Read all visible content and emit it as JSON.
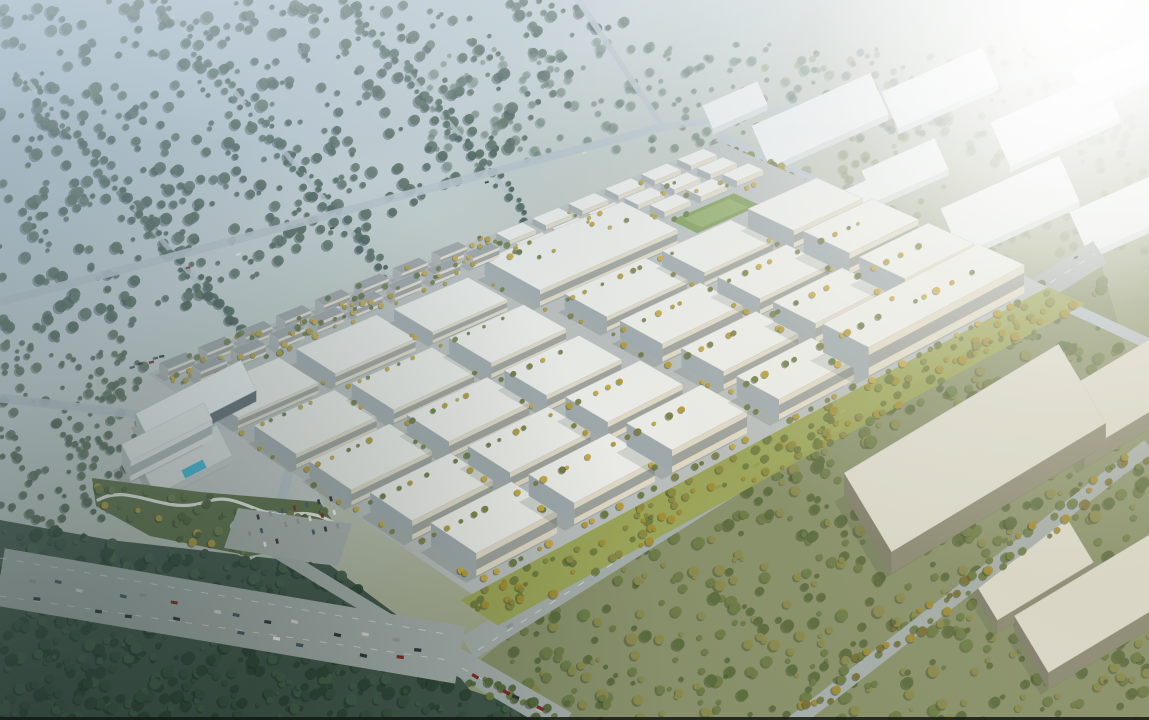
{
  "scene": "aerial-masterplan-render-industrial-park",
  "seed": 7,
  "palette": {
    "sky_tl": "#9db3c3",
    "sky_mid": "#c6d1d3",
    "ground_mid": "#b6bcab",
    "ground_olive": "#8f976f",
    "ground_deep": "#6e7a55",
    "haze_white": "#ffffff",
    "dark_corner": "#102019",
    "warm_tint": "#d6c89a",
    "tl_haze": "#a9becc",
    "road": "#a4adaa",
    "road_pale": "#b6c2c9",
    "dash": "#e9edeb",
    "campus_ground": "#b7bdbb",
    "roof": "#e9eae5",
    "roof_stroke": "#c2c7c1",
    "wall_front": "#ddd7c3",
    "wall_left": "#9ea8ab",
    "wall_right": "#ccccc0",
    "win_band": "#5d6b74",
    "res_roof": "#9aa1a3",
    "res_front": "#e2dccc",
    "res_left": "#a7adad",
    "res_right": "#d4d1c4",
    "res_win": "#55606a",
    "distant_roof": "#e7ebea",
    "distant_face": "#d2d9d8",
    "box_roof": "#dad8cb",
    "box_front": "#8b8974",
    "box_left": "#7f7d6a",
    "box_right": "#bcb9a7",
    "shadow": "#2e3e38",
    "greenway": "#99a352",
    "field_green": "#7d9a55",
    "field_inner": "#8fa964",
    "pool": "#3fb8d8",
    "pond": "#9cc0c4",
    "park_green": "#5c6e46",
    "path": "#e9eae4",
    "plaza": "#c3c8c5",
    "parking_lot": "#a9b0ac",
    "bottom_edge": "#141914"
  },
  "forests": [
    {
      "name": "forest-top-left",
      "poly": [
        [
          0,
          0
        ],
        [
          640,
          0
        ],
        [
          560,
          120
        ],
        [
          430,
          200
        ],
        [
          300,
          260
        ],
        [
          150,
          330
        ],
        [
          0,
          345
        ]
      ],
      "n": 520,
      "colors": [
        "#4a614f",
        "#54695a",
        "#43594b"
      ],
      "shadow": "#31434e",
      "rmin": 2,
      "rmax": 6,
      "op": 0.9
    },
    {
      "name": "forest-top-center",
      "poly": [
        [
          430,
          40
        ],
        [
          900,
          40
        ],
        [
          1000,
          150
        ],
        [
          760,
          140
        ],
        [
          560,
          160
        ],
        [
          430,
          180
        ]
      ],
      "n": 200,
      "colors": [
        "#5c7260",
        "#687d6a"
      ],
      "shadow": "#4a5f62",
      "rmin": 2,
      "rmax": 5,
      "op": 0.55
    },
    {
      "name": "forest-left-mid",
      "poly": [
        [
          0,
          345
        ],
        [
          150,
          330
        ],
        [
          135,
          470
        ],
        [
          110,
          540
        ],
        [
          0,
          520
        ]
      ],
      "n": 130,
      "colors": [
        "#4f624f",
        "#5a6b55"
      ],
      "shadow": "#3c4f49",
      "rmin": 2,
      "rmax": 5,
      "op": 0.85
    },
    {
      "name": "forest-bottom-left",
      "ground": "#41564a",
      "poly": [
        [
          0,
          520
        ],
        [
          110,
          540
        ],
        [
          330,
          565
        ],
        [
          430,
          640
        ],
        [
          470,
          690
        ],
        [
          560,
          720
        ],
        [
          0,
          720
        ]
      ],
      "n": 520,
      "colors": [
        "#2f4736",
        "#3a5340",
        "#44604a"
      ],
      "shadow": "#1f332c",
      "rmin": 2,
      "rmax": 6,
      "op": 0.95
    },
    {
      "name": "forest-bottom-right",
      "ground": "#87906a",
      "poly": [
        [
          480,
          660
        ],
        [
          560,
          720
        ],
        [
          1149,
          720
        ],
        [
          1149,
          430
        ],
        [
          1100,
          260
        ],
        [
          1040,
          290
        ],
        [
          800,
          430
        ],
        [
          600,
          560
        ]
      ],
      "n": 650,
      "colors": [
        "#5b6b3e",
        "#6d7c47",
        "#8a8a4e"
      ],
      "shadow": "#46552f",
      "rmin": 2,
      "rmax": 6,
      "op": 0.95
    },
    {
      "name": "grove-top-right",
      "poly": [
        [
          760,
          60
        ],
        [
          1149,
          40
        ],
        [
          1149,
          260
        ],
        [
          1000,
          260
        ],
        [
          830,
          230
        ]
      ],
      "n": 220,
      "colors": [
        "#7d8a68",
        "#8a9670"
      ],
      "shadow": "#6a7a5e",
      "rmin": 2,
      "rmax": 5,
      "op": 0.5
    }
  ],
  "windbreaks": [
    {
      "x1": 150,
      "y1": -10,
      "x2": 470,
      "y2": 375,
      "w": 5,
      "n": 80,
      "jitter": 8
    },
    {
      "x1": 18,
      "y1": 70,
      "x2": 280,
      "y2": 380,
      "w": 5,
      "n": 70,
      "jitter": 8
    },
    {
      "x1": 330,
      "y1": -20,
      "x2": 560,
      "y2": 255,
      "w": 4,
      "n": 60,
      "jitter": 7
    }
  ],
  "windbreak_colors": [
    "#44604e",
    "#4e6858",
    "#3c5448"
  ],
  "top_roads": [
    {
      "x1": 663,
      "y1": 127,
      "x2": 0,
      "y2": 302,
      "w": 8,
      "op": 0.9
    },
    {
      "x1": 663,
      "y1": 127,
      "x2": 575,
      "y2": -5,
      "w": 6,
      "op": 0.9
    },
    {
      "x1": 663,
      "y1": 127,
      "x2": 1149,
      "y2": 58,
      "w": 7,
      "op": 0.75
    },
    {
      "x1": 0,
      "y1": 398,
      "x2": 300,
      "y2": 434,
      "w": 9,
      "op": 0.9
    },
    {
      "x1": 300,
      "y1": 434,
      "x2": 268,
      "y2": 545,
      "w": 10,
      "op": 0.9
    },
    {
      "x1": 718,
      "y1": 136,
      "x2": 1046,
      "y2": 292,
      "w": 11,
      "op": 0.95
    },
    {
      "x1": 1043,
      "y1": 295,
      "x2": 1149,
      "y2": 344,
      "w": 11,
      "op": 0.95
    }
  ],
  "main_roads": [
    {
      "name": "avenue-west",
      "x1": 0,
      "y1": 577,
      "x2": 460,
      "y2": 655,
      "w": 58
    },
    {
      "name": "avenue-northeast",
      "x1": 468,
      "y1": 648,
      "x2": 1100,
      "y2": 252,
      "w": 26
    },
    {
      "name": "road-south",
      "x1": 455,
      "y1": 660,
      "x2": 565,
      "y2": 724,
      "w": 26
    },
    {
      "name": "road-entrance",
      "x1": 415,
      "y1": 636,
      "x2": 262,
      "y2": 543,
      "w": 13
    },
    {
      "name": "road-outer-southeast",
      "x1": 792,
      "y1": 724,
      "x2": 1149,
      "y2": 446,
      "w": 15
    }
  ],
  "road_tree_lines": [
    {
      "x1": 800,
      "y1": 712,
      "x2": 1145,
      "y2": 452,
      "n": 60,
      "jitter": 10,
      "colors": [
        "#6d7b42",
        "#a08a33",
        "#7c6f35"
      ]
    },
    {
      "x1": 725,
      "y1": 148,
      "x2": 1040,
      "y2": 290,
      "n": 55,
      "jitter": 7,
      "colors": [
        "#7a8448",
        "#a8923a",
        "#667440"
      ]
    },
    {
      "x1": 470,
      "y1": 676,
      "x2": 560,
      "y2": 722,
      "n": 18,
      "jitter": 9,
      "colors": [
        "#55683c",
        "#6d7b42"
      ]
    }
  ],
  "dashes": [
    {
      "x1": 0,
      "y1": 558,
      "x2": 452,
      "y2": 635
    },
    {
      "x1": 0,
      "y1": 596,
      "x2": 448,
      "y2": 660
    },
    {
      "x1": 478,
      "y1": 650,
      "x2": 1095,
      "y2": 254
    },
    {
      "x1": 462,
      "y1": 668,
      "x2": 560,
      "y2": 722
    }
  ],
  "car_colors": [
    "#f2f2f0",
    "#2e3539",
    "#97999b",
    "#7e2a24",
    "#45566b",
    "#d8d8d2"
  ],
  "car_runs": [
    {
      "x1": 15,
      "y1": 575,
      "x2": 440,
      "y2": 652,
      "n": 14
    },
    {
      "x1": 30,
      "y1": 597,
      "x2": 430,
      "y2": 665,
      "n": 9
    },
    {
      "x1": 478,
      "y1": 643,
      "x2": 1085,
      "y2": 255,
      "n": 9
    },
    {
      "x1": 470,
      "y1": 672,
      "x2": 555,
      "y2": 716,
      "n": 4
    },
    {
      "x1": 600,
      "y1": 145,
      "x2": 120,
      "y2": 290,
      "n": 5
    },
    {
      "x1": 128,
      "y1": 366,
      "x2": 168,
      "y2": 356,
      "n": 5
    }
  ],
  "parking": {
    "poly": [
      [
        238,
        508
      ],
      [
        352,
        524
      ],
      [
        338,
        566
      ],
      [
        224,
        548
      ]
    ],
    "grid": {
      "x": 246,
      "y": 520,
      "cols": 8,
      "rows": 3,
      "dx": 12.5,
      "dy": 14,
      "rot": -14,
      "car_w": 5,
      "car_h": 2.6
    }
  },
  "plaza_poly": [
    [
      95,
      380
    ],
    [
      265,
      370
    ],
    [
      330,
      520
    ],
    [
      250,
      560
    ],
    [
      110,
      500
    ]
  ],
  "park": {
    "poly": [
      [
        92,
        478
      ],
      [
        200,
        492
      ],
      [
        320,
        502
      ],
      [
        345,
        540
      ],
      [
        250,
        556
      ],
      [
        150,
        536
      ],
      [
        96,
        506
      ]
    ],
    "pond": {
      "cx": 255,
      "cy": 521,
      "rx": 26,
      "ry": 9,
      "rot": -14
    },
    "path_d": "M 98 500 C 130 482 165 516 205 502 C 240 490 255 520 295 514 C 315 511 330 520 342 528",
    "trees_n": 55,
    "tree_colors": [
      "#4c6038",
      "#5c7042",
      "#b29a36",
      "#6d7c47"
    ]
  },
  "landmark_prisms": [
    {
      "name": "exhibition-hall",
      "cx": 196,
      "cy": 413,
      "w": 118,
      "h": 34,
      "rot": -27,
      "hh": 11,
      "roof": "#edf0f0",
      "front": "#5e6a70",
      "left": "#aab3b4",
      "right": "#cdd3d2"
    },
    {
      "name": "hotel-podium",
      "cx": 186,
      "cy": 467,
      "w": 86,
      "h": 34,
      "rot": -27,
      "hh": 7,
      "roof": "#dde0dd",
      "front": "#c6cbc9",
      "left": "#aab0ae",
      "right": "#cfd3d0"
    },
    {
      "name": "hotel-tower",
      "cx": 167,
      "cy": 452,
      "w": 92,
      "h": 19,
      "rot": -27,
      "hh": 20,
      "roof": "#e7e9e7",
      "front": "#e4e7e5",
      "left": "#b3babb",
      "right": "#d8dbd8",
      "win": "#76848c"
    }
  ],
  "pool": {
    "cx": 194,
    "cy": 469,
    "w": 24,
    "h": 9,
    "rot": -27
  },
  "distant_boxes": [
    {
      "cx": 820,
      "cy": 120,
      "w": 130,
      "h": 45
    },
    {
      "cx": 940,
      "cy": 88,
      "w": 110,
      "h": 40
    },
    {
      "cx": 1055,
      "cy": 120,
      "w": 120,
      "h": 48
    },
    {
      "cx": 1120,
      "cy": 70,
      "w": 90,
      "h": 40
    },
    {
      "cx": 905,
      "cy": 170,
      "w": 80,
      "h": 34
    },
    {
      "cx": 1010,
      "cy": 205,
      "w": 130,
      "h": 50
    },
    {
      "cx": 1120,
      "cy": 215,
      "w": 90,
      "h": 46
    },
    {
      "cx": 845,
      "cy": 205,
      "w": 60,
      "h": 28
    },
    {
      "cx": 735,
      "cy": 105,
      "w": 60,
      "h": 25
    }
  ],
  "distant_rot": -24,
  "br_boxes": [
    {
      "cx": 902,
      "cy": 368,
      "w": 160,
      "h": 56,
      "hh": 15
    },
    {
      "cx": 1124,
      "cy": 408,
      "w": 130,
      "h": 62,
      "hh": 17
    },
    {
      "cx": 975,
      "cy": 470,
      "w": 250,
      "h": 92,
      "hh": 22
    },
    {
      "cx": 1032,
      "cy": 582,
      "w": 112,
      "h": 52,
      "hh": 13
    },
    {
      "cx": 1100,
      "cy": 620,
      "w": 160,
      "h": 66,
      "hh": 17
    }
  ],
  "br_rot": -31,
  "campus": {
    "quad": [
      [
        148,
        374
      ],
      [
        720,
        142
      ],
      [
        1048,
        287
      ],
      [
        472,
        594
      ]
    ],
    "warehouses": [
      {
        "p": 0.01,
        "q": 0.14,
        "dp": 0.14,
        "dq": 0.12,
        "h": 15
      },
      {
        "p": 0.18,
        "q": 0.14,
        "dp": 0.14,
        "dq": 0.12,
        "h": 17
      },
      {
        "p": 0.35,
        "q": 0.14,
        "dp": 0.13,
        "dq": 0.12,
        "h": 15
      },
      {
        "p": 0.52,
        "q": 0.12,
        "dp": 0.24,
        "dq": 0.17,
        "h": 22
      },
      {
        "p": 0.01,
        "q": 0.31,
        "dp": 0.14,
        "dq": 0.13,
        "h": 16
      },
      {
        "p": 0.18,
        "q": 0.31,
        "dp": 0.14,
        "dq": 0.13,
        "h": 15
      },
      {
        "p": 0.35,
        "q": 0.31,
        "dp": 0.13,
        "dq": 0.13,
        "h": 17
      },
      {
        "p": 0.54,
        "q": 0.33,
        "dp": 0.14,
        "dq": 0.13,
        "h": 16
      },
      {
        "p": 0.71,
        "q": 0.33,
        "dp": 0.12,
        "dq": 0.13,
        "h": 15
      },
      {
        "p": 0.86,
        "q": 0.33,
        "dp": 0.12,
        "dq": 0.14,
        "h": 19
      },
      {
        "p": 0.01,
        "q": 0.48,
        "dp": 0.14,
        "dq": 0.13,
        "h": 15
      },
      {
        "p": 0.18,
        "q": 0.48,
        "dp": 0.14,
        "dq": 0.13,
        "h": 16
      },
      {
        "p": 0.35,
        "q": 0.48,
        "dp": 0.13,
        "dq": 0.13,
        "h": 15
      },
      {
        "p": 0.54,
        "q": 0.5,
        "dp": 0.14,
        "dq": 0.13,
        "h": 17
      },
      {
        "p": 0.71,
        "q": 0.5,
        "dp": 0.12,
        "dq": 0.13,
        "h": 15
      },
      {
        "p": 0.86,
        "q": 0.5,
        "dp": 0.12,
        "dq": 0.14,
        "h": 20
      },
      {
        "p": 0.02,
        "q": 0.65,
        "dp": 0.14,
        "dq": 0.13,
        "h": 16
      },
      {
        "p": 0.19,
        "q": 0.65,
        "dp": 0.14,
        "dq": 0.13,
        "h": 15
      },
      {
        "p": 0.36,
        "q": 0.65,
        "dp": 0.13,
        "dq": 0.13,
        "h": 16
      },
      {
        "p": 0.55,
        "q": 0.67,
        "dp": 0.13,
        "dq": 0.13,
        "h": 15
      },
      {
        "p": 0.71,
        "q": 0.67,
        "dp": 0.12,
        "dq": 0.13,
        "h": 16
      },
      {
        "p": 0.86,
        "q": 0.67,
        "dp": 0.12,
        "dq": 0.14,
        "h": 18
      },
      {
        "p": 0.03,
        "q": 0.82,
        "dp": 0.14,
        "dq": 0.14,
        "h": 17
      },
      {
        "p": 0.2,
        "q": 0.82,
        "dp": 0.14,
        "dq": 0.14,
        "h": 16
      },
      {
        "p": 0.37,
        "q": 0.82,
        "dp": 0.13,
        "dq": 0.14,
        "h": 17
      },
      {
        "p": 0.55,
        "q": 0.84,
        "dp": 0.13,
        "dq": 0.13,
        "h": 15
      },
      {
        "p": 0.7,
        "q": 0.84,
        "dp": 0.27,
        "dq": 0.14,
        "h": 21
      }
    ],
    "workshops": [
      {
        "p0": 0.6,
        "q": 0.015,
        "dp": 0.38,
        "dq": 0.042,
        "n": 6,
        "h": 7
      },
      {
        "p0": 0.6,
        "q": 0.075,
        "dp": 0.38,
        "dq": 0.042,
        "n": 6,
        "h": 7
      },
      {
        "p0": 0.8,
        "q": 0.135,
        "dp": 0.19,
        "dq": 0.045,
        "n": 3,
        "h": 7
      }
    ],
    "field": {
      "p": 0.8,
      "q": 0.2,
      "dp": 0.11,
      "dq": 0.08
    },
    "residential": [
      {
        "q": 0.008,
        "p0": 0.015,
        "n": 8,
        "step": 0.068,
        "dp": 0.046,
        "dq": 0.028,
        "h": 15
      },
      {
        "q": 0.055,
        "p0": 0.045,
        "n": 8,
        "step": 0.068,
        "dp": 0.046,
        "dq": 0.028,
        "h": 15
      }
    ],
    "res_trees": {
      "n": 90,
      "p0": 0.0,
      "p1": 0.6,
      "q0": -0.01,
      "q1": 0.1,
      "colors": [
        "#5c7042",
        "#b29a36",
        "#c7a83e",
        "#6d7c47"
      ]
    },
    "street_tree_colors": [
      "#b59b33",
      "#c7a83e",
      "#7d8145",
      "#6c7a42"
    ],
    "greenway": {
      "q0": 1.0,
      "q1": 1.115,
      "p0": -0.02,
      "p1": 1.0,
      "trees": 150,
      "colors": [
        "#6f7d3f",
        "#a38e33",
        "#8a8a44"
      ]
    },
    "ne_strip": {
      "q0": -0.055,
      "q1": 0.0,
      "p0": 0.62,
      "p1": 1.0,
      "fill": "#a9ae8a",
      "op": 0.0
    }
  },
  "bottom_strip": {
    "h": 3
  }
}
